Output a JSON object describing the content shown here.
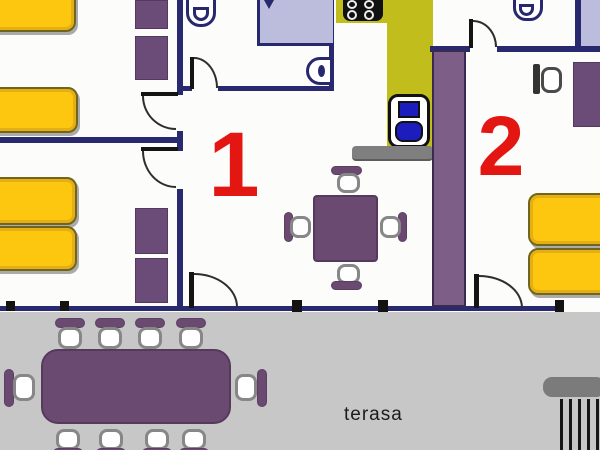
{
  "labels": {
    "room1": "1",
    "room2": "2",
    "terrace": "terasa"
  },
  "palette": {
    "wall_navy": "#29296f",
    "bed_yellow": "#fcc70e",
    "bed_border": "#6f661d",
    "furniture_purple": "#6b4a72",
    "wardrobe_purple": "#6b4b78",
    "pillar_purple": "#7d5e87",
    "kitchen_olive": "#c1bd1c",
    "shower_lavender": "#bcbcdc",
    "appliance_blue": "#1d1dbe",
    "terrace_gray": "#c7c7c7",
    "counter_gray": "#7f7f7f",
    "room_number_red": "#e41612"
  }
}
